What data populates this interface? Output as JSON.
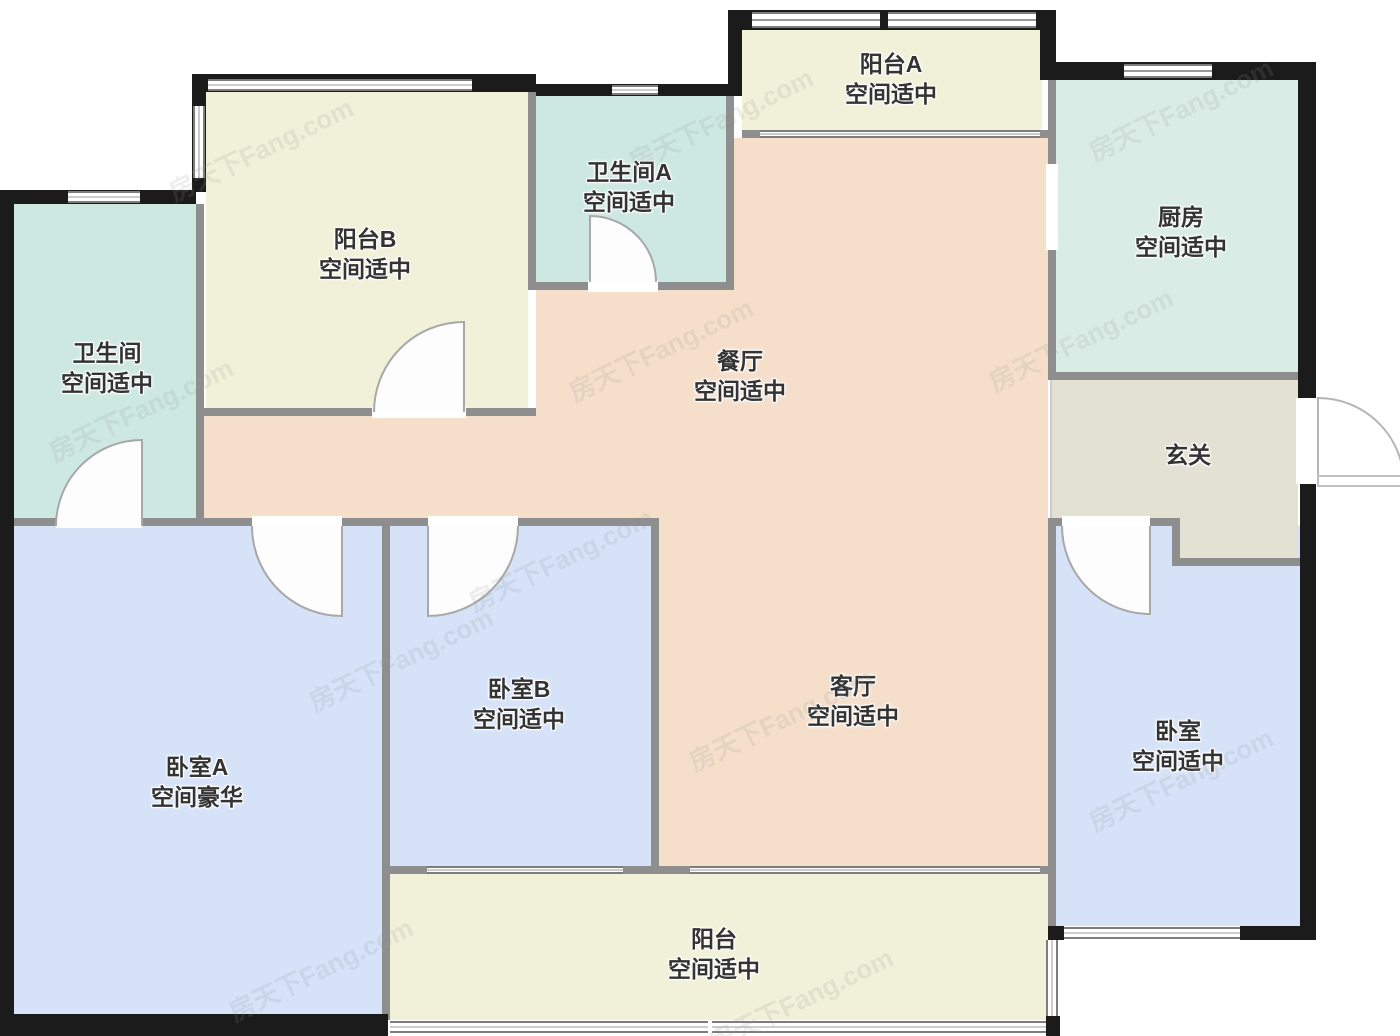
{
  "watermark": {
    "text": "房天下Fang.com"
  },
  "palette": {
    "balcony": "#f1f0d8",
    "bathroom": "#cde8e0",
    "kitchen": "#d9ece5",
    "living": "#f5dfcb",
    "bedroom": "#d6e2f8",
    "hallway": "#e2e1d2",
    "wall": "#1b1b1b",
    "iwall": "#8e8e8e",
    "label": "#333333",
    "door": "#a8a8a8"
  },
  "rooms": {
    "balcony_a": {
      "name": "阳台A",
      "status": "空间适中"
    },
    "bathroom_a": {
      "name": "卫生间A",
      "status": "空间适中"
    },
    "balcony_b": {
      "name": "阳台B",
      "status": "空间适中"
    },
    "kitchen": {
      "name": "厨房",
      "status": "空间适中"
    },
    "bathroom": {
      "name": "卫生间",
      "status": "空间适中"
    },
    "dining": {
      "name": "餐厅",
      "status": "空间适中"
    },
    "hallway": {
      "name": "玄关",
      "status": ""
    },
    "bedroom_a": {
      "name": "卧室A",
      "status": "空间豪华"
    },
    "bedroom_b": {
      "name": "卧室B",
      "status": "空间适中"
    },
    "living": {
      "name": "客厅",
      "status": "空间适中"
    },
    "bedroom": {
      "name": "卧室",
      "status": "空间适中"
    },
    "balcony": {
      "name": "阳台",
      "status": "空间适中"
    }
  }
}
